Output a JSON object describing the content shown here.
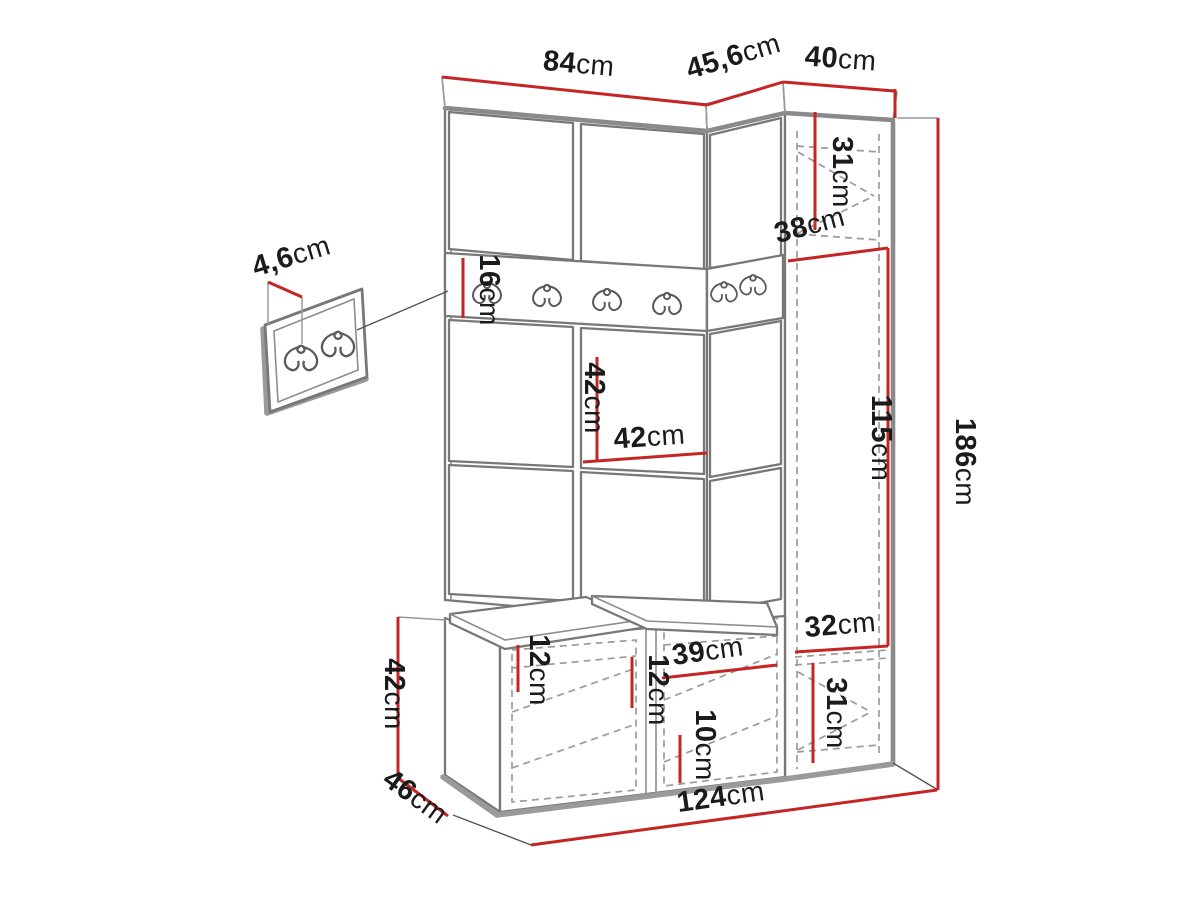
{
  "meta": {
    "type": "furniture-dimension-diagram",
    "units": "cm"
  },
  "colors": {
    "background": "#ffffff",
    "dimension_line": "#c42525",
    "outline": "#787878",
    "shadow_edge": "#8a8a8a",
    "dashed_line": "#9b9b9b",
    "label_text": "#1b1b1b"
  },
  "dims": [
    {
      "id": "top-width-main",
      "num": "84",
      "unit": "cm"
    },
    {
      "id": "top-width-corner",
      "num": "45,6",
      "unit": "cm"
    },
    {
      "id": "top-width-cabinet",
      "num": "40",
      "unit": "cm"
    },
    {
      "id": "wall-panel-depth",
      "num": "4,6",
      "unit": "cm"
    },
    {
      "id": "hook-rail-height",
      "num": "16",
      "unit": "cm"
    },
    {
      "id": "cabinet-top-section",
      "num": "31",
      "unit": "cm"
    },
    {
      "id": "cabinet-depth",
      "num": "38",
      "unit": "cm"
    },
    {
      "id": "panel-square-height",
      "num": "42",
      "unit": "cm"
    },
    {
      "id": "panel-square-width",
      "num": "42",
      "unit": "cm"
    },
    {
      "id": "cabinet-middle-section",
      "num": "115",
      "unit": "cm"
    },
    {
      "id": "total-height",
      "num": "186",
      "unit": "cm"
    },
    {
      "id": "cabinet-shelf-width",
      "num": "32",
      "unit": "cm"
    },
    {
      "id": "cabinet-bottom-section",
      "num": "31",
      "unit": "cm"
    },
    {
      "id": "bench-gap-left",
      "num": "12",
      "unit": "cm"
    },
    {
      "id": "bench-gap-middle",
      "num": "12",
      "unit": "cm"
    },
    {
      "id": "bench-shelf-width",
      "num": "39",
      "unit": "cm"
    },
    {
      "id": "bench-gap-right",
      "num": "10",
      "unit": "cm"
    },
    {
      "id": "bench-height",
      "num": "42",
      "unit": "cm"
    },
    {
      "id": "bench-depth",
      "num": "46",
      "unit": "cm"
    },
    {
      "id": "total-width",
      "num": "124",
      "unit": "cm"
    }
  ]
}
